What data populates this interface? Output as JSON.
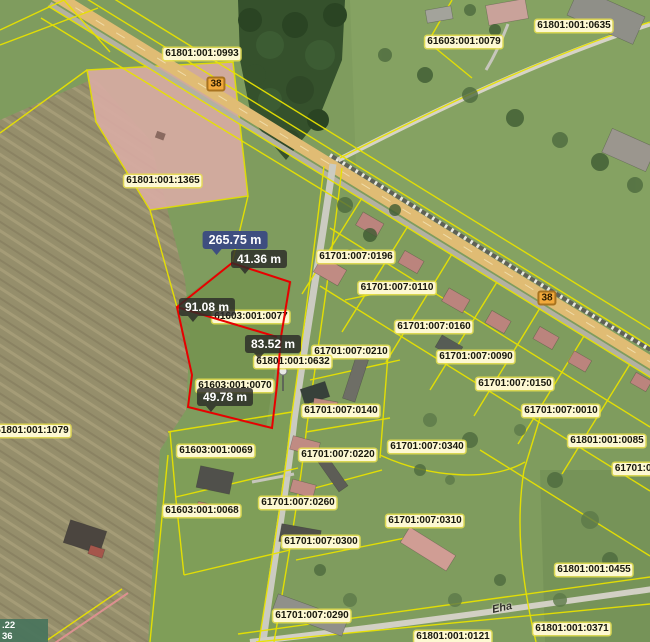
{
  "map": {
    "description": "cadastral-orthophoto-map-with-distance-measurement",
    "colors": {
      "parcel_line": "#e8e200",
      "measure_line": "#e80000",
      "selected_parcel_fill": "#d9aca4",
      "parcel_label_bg": "#fdf8d2",
      "total_label_bg": "#3e4e80",
      "segment_label_bg": "rgba(43,43,40,0.82)",
      "road_badge_bg": "#f2a93b",
      "coordinate_box_bg": "rgba(72,116,92,0.92)"
    },
    "parcel_labels": [
      {
        "text": "61801:001:0993",
        "x": 202,
        "y": 54
      },
      {
        "text": "61603:001:0079",
        "x": 464,
        "y": 42
      },
      {
        "text": "61801:001:0635",
        "x": 574,
        "y": 26
      },
      {
        "text": "61801:001:1365",
        "x": 163,
        "y": 181
      },
      {
        "text": "61701:007:0196",
        "x": 356,
        "y": 257
      },
      {
        "text": "61701:007:0110",
        "x": 397,
        "y": 288
      },
      {
        "text": "61603:001:0077",
        "x": 251,
        "y": 317
      },
      {
        "text": "61701:007:0160",
        "x": 434,
        "y": 327
      },
      {
        "text": "61701:007:0210",
        "x": 351,
        "y": 352
      },
      {
        "text": "61701:007:0090",
        "x": 476,
        "y": 357
      },
      {
        "text": "61801:001:0632",
        "x": 293,
        "y": 362
      },
      {
        "text": "61701:007:0150",
        "x": 515,
        "y": 384
      },
      {
        "text": "61603:001:0070",
        "x": 235,
        "y": 386
      },
      {
        "text": "61701:007:0140",
        "x": 341,
        "y": 411
      },
      {
        "text": "61701:007:0010",
        "x": 561,
        "y": 411
      },
      {
        "text": "61801:001:1079",
        "x": 32,
        "y": 431
      },
      {
        "text": "61603:001:0069",
        "x": 216,
        "y": 451
      },
      {
        "text": "61701:007:0340",
        "x": 427,
        "y": 447
      },
      {
        "text": "61701:007:0220",
        "x": 338,
        "y": 455
      },
      {
        "text": "61801:001:0085",
        "x": 607,
        "y": 441
      },
      {
        "text": "61701:00",
        "x": 636,
        "y": 469
      },
      {
        "text": "61701:007:0260",
        "x": 298,
        "y": 503
      },
      {
        "text": "61603:001:0068",
        "x": 202,
        "y": 511
      },
      {
        "text": "61701:007:0310",
        "x": 425,
        "y": 521
      },
      {
        "text": "61701:007:0300",
        "x": 321,
        "y": 542
      },
      {
        "text": "61801:001:0455",
        "x": 594,
        "y": 570
      },
      {
        "text": "61701:007:0290",
        "x": 312,
        "y": 616
      },
      {
        "text": "61801:001:0121",
        "x": 453,
        "y": 637
      },
      {
        "text": "61801:001:0371",
        "x": 572,
        "y": 629
      }
    ],
    "road_badges": [
      {
        "text": "38",
        "x": 216,
        "y": 84
      },
      {
        "text": "38",
        "x": 547,
        "y": 298
      }
    ],
    "measurements": {
      "total": {
        "text": "265.75 m",
        "x": 235,
        "y": 240
      },
      "segments": [
        {
          "text": "41.36 m",
          "x": 259,
          "y": 259
        },
        {
          "text": "91.08 m",
          "x": 207,
          "y": 307
        },
        {
          "text": "83.52 m",
          "x": 273,
          "y": 344
        },
        {
          "text": "49.78 m",
          "x": 225,
          "y": 397
        }
      ]
    },
    "street_label": {
      "text": "Eha",
      "x": 492,
      "y": 602,
      "rotation": -12
    },
    "coordinate_readout": {
      "line1": ".22",
      "line2": "36"
    }
  }
}
